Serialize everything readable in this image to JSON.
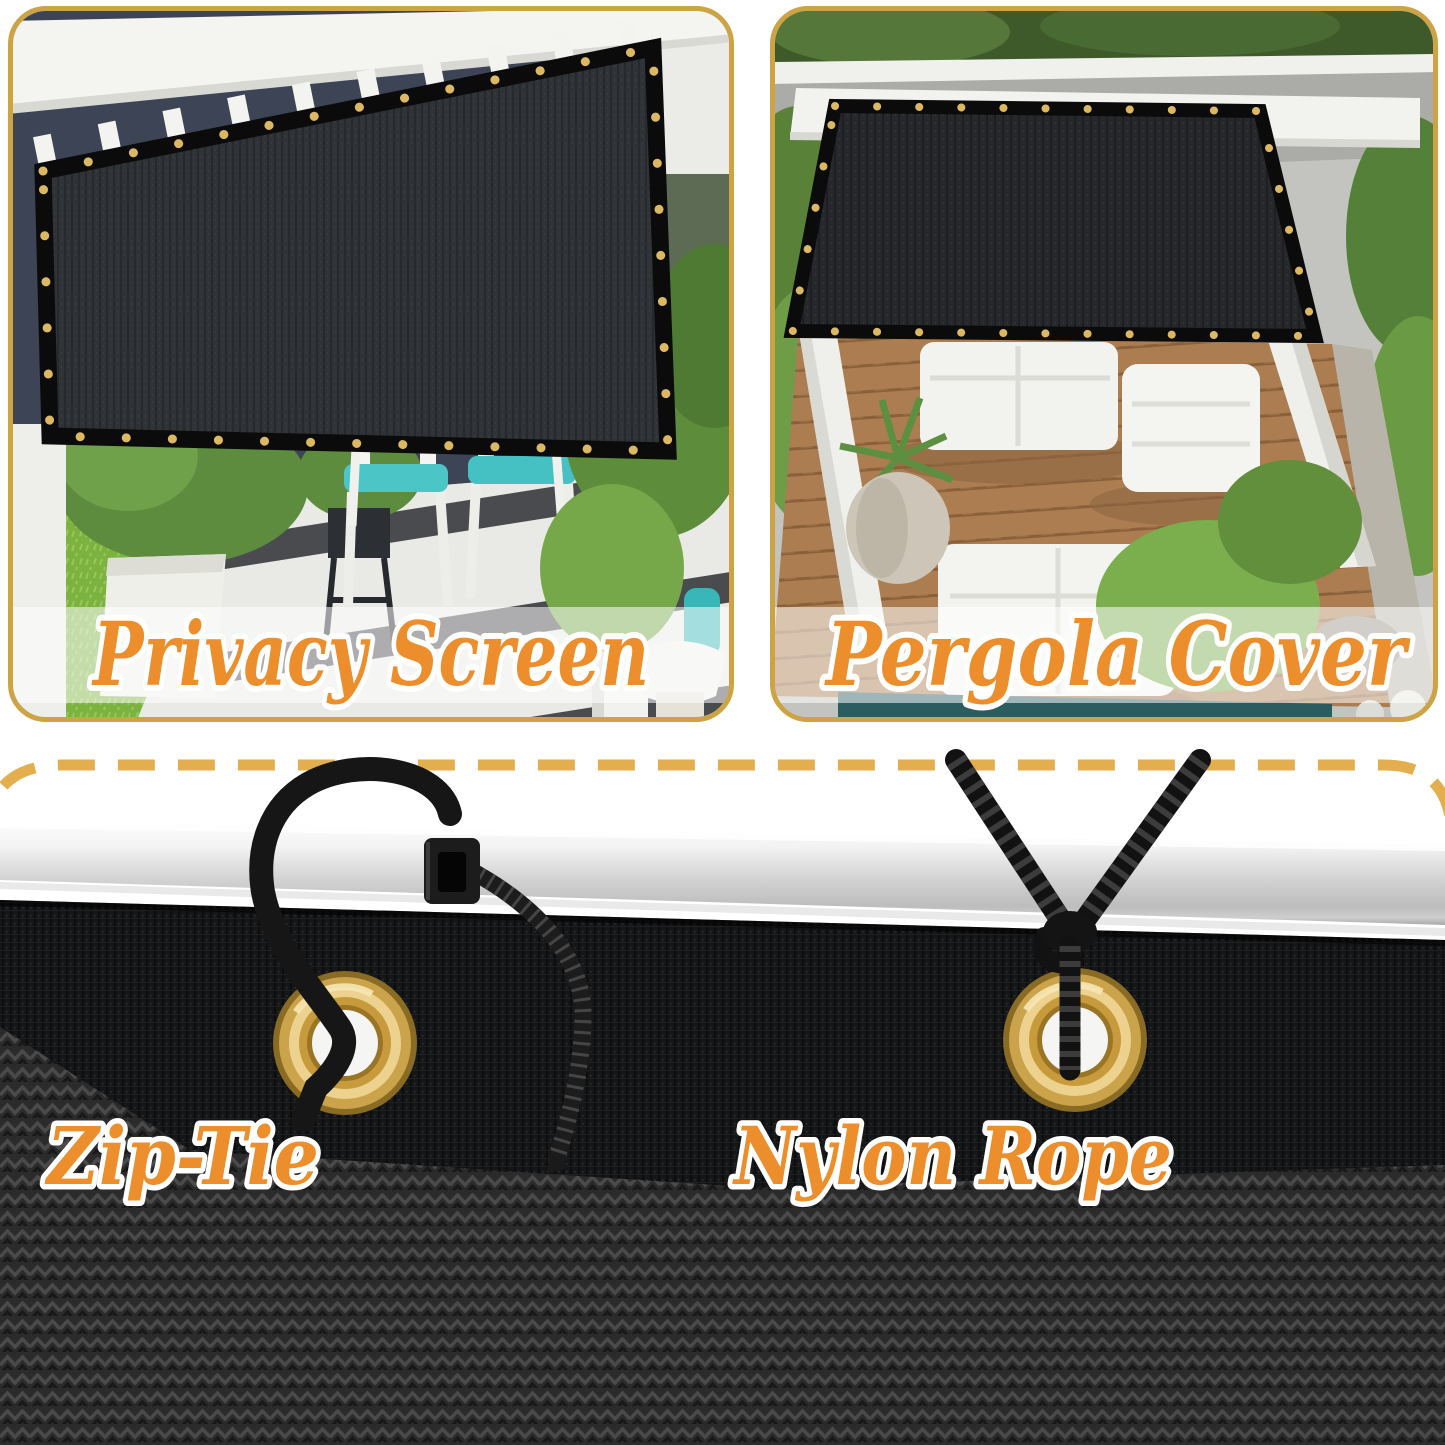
{
  "page": {
    "background": "#ffffff",
    "type_note": "product collage: shade mesh privacy screen / pergola cover with mounting hardware"
  },
  "style": {
    "frame_gold": "#CDA344",
    "dash_gold": "#E3AF4E",
    "label_orange": "#EB8E2B",
    "label_outline": "#FFFFFF",
    "mesh_dark": "#17181A",
    "mesh_weave": "#2B2B2B",
    "grommet_gold": "#D9A94E",
    "pole_silver": "#D6D6D6",
    "banner_overlay": "rgba(255,255,255,0.55)"
  },
  "panels": [
    {
      "id": "privacy-screen",
      "label": "Privacy Screen",
      "icon": "privacy-screen-photo"
    },
    {
      "id": "pergola-cover",
      "label": "Pergola Cover",
      "icon": "pergola-cover-photo"
    }
  ],
  "hardware": [
    {
      "id": "zip-tie",
      "label": "Zip-Tie",
      "icon": "zip-tie-icon"
    },
    {
      "id": "nylon-rope",
      "label": "Nylon Rope",
      "icon": "nylon-rope-icon"
    }
  ]
}
